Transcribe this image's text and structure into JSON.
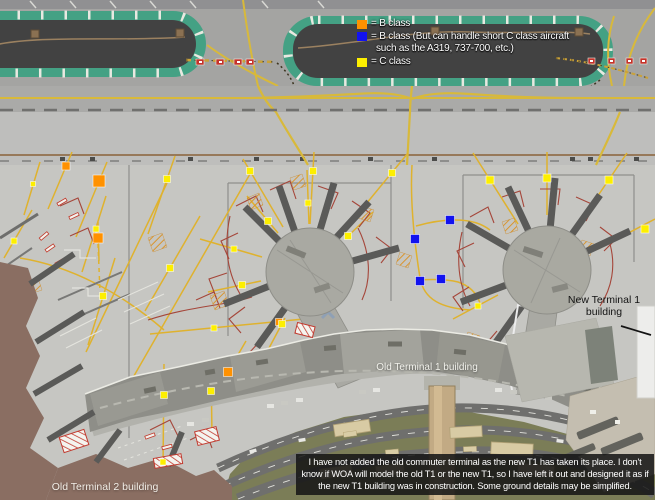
{
  "legend": {
    "items": [
      {
        "class_key": "B",
        "color": "#ff9100",
        "label": "= B class"
      },
      {
        "class_key": "BC",
        "color": "#1212ef",
        "label": "= B class (But can handle short C class aircraft",
        "label_line2": "such as the A319, 737-700, etc.)"
      },
      {
        "class_key": "C",
        "color": "#fdef00",
        "label": "= C class"
      }
    ]
  },
  "map": {
    "labels": {
      "new_terminal_1": {
        "line1": "New Terminal 1",
        "line2": "building"
      },
      "old_terminal_1": "Old Terminal 1 building",
      "old_terminal_2": "Old Terminal 2 building"
    },
    "class_colors": {
      "B": "#ff9100",
      "BC": "#1212ef",
      "C": "#fdef00"
    },
    "markers": [
      {
        "class": "B",
        "x": 66,
        "y": 166,
        "s": 8,
        "line": [
          72,
          152,
          48,
          209
        ]
      },
      {
        "class": "B",
        "x": 99,
        "y": 181,
        "s": 12,
        "line": [
          107,
          162,
          76,
          237
        ]
      },
      {
        "class": "B",
        "x": 98,
        "y": 238,
        "s": 10,
        "line": [
          98,
          222,
          99,
          261
        ]
      },
      {
        "class": "B",
        "x": 228,
        "y": 372,
        "s": 9,
        "line": [
          214,
          396,
          246,
          341
        ]
      },
      {
        "class": "B",
        "x": 279,
        "y": 322,
        "s": 7
      },
      {
        "class": "BC",
        "x": 450,
        "y": 220,
        "s": 9
      },
      {
        "class": "BC",
        "x": 415,
        "y": 239,
        "s": 9
      },
      {
        "class": "BC",
        "x": 420,
        "y": 281,
        "s": 9
      },
      {
        "class": "BC",
        "x": 441,
        "y": 279,
        "s": 9
      },
      {
        "class": "C",
        "x": 33,
        "y": 184,
        "s": 5,
        "line": [
          40,
          162,
          24,
          215
        ]
      },
      {
        "class": "C",
        "x": 14,
        "y": 241,
        "s": 6,
        "line": [
          4,
          258,
          32,
          210
        ]
      },
      {
        "class": "C",
        "x": 96,
        "y": 229,
        "s": 6,
        "line": [
          106,
          196,
          82,
          272
        ]
      },
      {
        "class": "C",
        "x": 103,
        "y": 296,
        "s": 7,
        "line": [
          115,
          258,
          88,
          345
        ]
      },
      {
        "class": "C",
        "x": 167,
        "y": 179,
        "s": 7,
        "line": [
          175,
          156,
          148,
          234
        ]
      },
      {
        "class": "C",
        "x": 170,
        "y": 268,
        "s": 7,
        "line": [
          200,
          216,
          145,
          311
        ]
      },
      {
        "class": "C",
        "x": 164,
        "y": 395,
        "s": 7,
        "line": [
          164,
          364,
          163,
          470
        ]
      },
      {
        "class": "C",
        "x": 211,
        "y": 391,
        "s": 7,
        "line": [
          211,
          362,
          212,
          437
        ]
      },
      {
        "class": "C",
        "x": 214,
        "y": 328,
        "s": 6
      },
      {
        "class": "C",
        "x": 163,
        "y": 462,
        "s": 6
      },
      {
        "class": "C",
        "x": 250,
        "y": 171,
        "s": 7,
        "line": [
          283,
          227,
          243,
          159
        ]
      },
      {
        "class": "C",
        "x": 313,
        "y": 171,
        "s": 7,
        "line": [
          310,
          224,
          314,
          152
        ]
      },
      {
        "class": "C",
        "x": 392,
        "y": 173,
        "s": 7,
        "line": [
          343,
          232,
          408,
          153
        ]
      },
      {
        "class": "C",
        "x": 268,
        "y": 221,
        "s": 7,
        "line": [
          278,
          233,
          247,
          196
        ]
      },
      {
        "class": "C",
        "x": 308,
        "y": 203,
        "s": 6,
        "line": [
          309,
          224,
          307,
          170
        ]
      },
      {
        "class": "C",
        "x": 348,
        "y": 236,
        "s": 7,
        "line": [
          345,
          239,
          373,
          212
        ]
      },
      {
        "class": "C",
        "x": 234,
        "y": 249,
        "s": 6,
        "line": [
          262,
          257,
          200,
          239
        ]
      },
      {
        "class": "C",
        "x": 242,
        "y": 285,
        "s": 7,
        "line": [
          261,
          281,
          208,
          292
        ]
      },
      {
        "class": "C",
        "x": 282,
        "y": 324,
        "s": 7,
        "line": [
          285,
          318,
          268,
          350
        ]
      },
      {
        "class": "C",
        "x": 490,
        "y": 180,
        "s": 8,
        "line": [
          518,
          224,
          473,
          153
        ]
      },
      {
        "class": "C",
        "x": 547,
        "y": 178,
        "s": 8,
        "line": [
          547,
          215,
          547,
          152
        ]
      },
      {
        "class": "C",
        "x": 609,
        "y": 180,
        "s": 8,
        "line": [
          578,
          225,
          627,
          153
        ]
      },
      {
        "class": "C",
        "x": 645,
        "y": 229,
        "s": 8,
        "line": [
          598,
          249,
          655,
          219
        ]
      },
      {
        "class": "C",
        "x": 478,
        "y": 306,
        "s": 6,
        "line": [
          498,
          295,
          453,
          319
        ]
      }
    ]
  },
  "note": {
    "text": "I have not added the old commuter terminal as the new T1 has taken its place. I don't know if WOA will model the old T1 or the new T1, so I have left it out and designed it as if the new T1 building was in construction. Some ground details may be simplified."
  }
}
